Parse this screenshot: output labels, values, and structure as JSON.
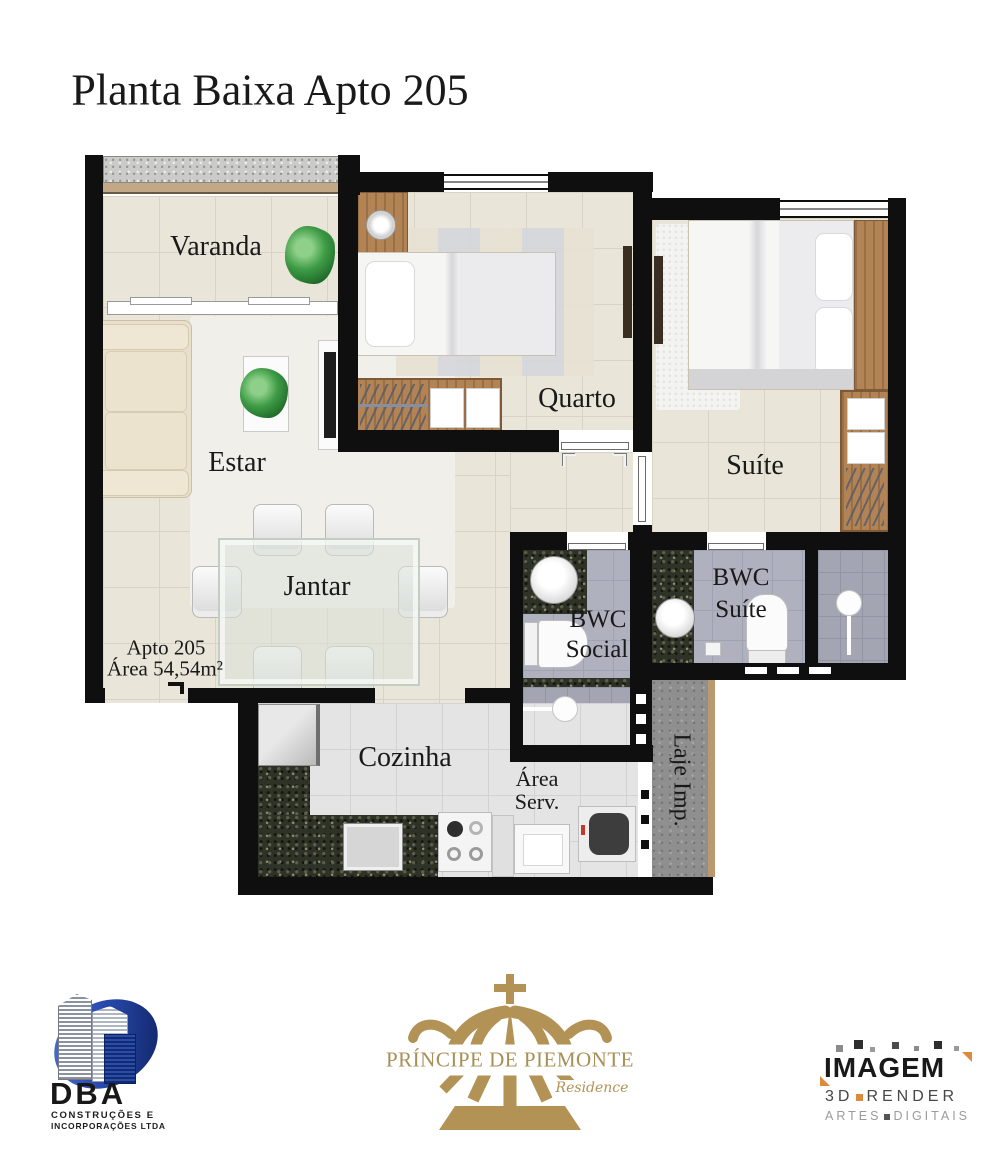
{
  "title": "Planta Baixa Apto 205",
  "plan": {
    "labels": {
      "varanda": "Varanda",
      "estar": "Estar",
      "jantar": "Jantar",
      "quarto": "Quarto",
      "suite": "Suíte",
      "bwc_social": [
        "BWC",
        "Social"
      ],
      "bwc_suite": [
        "BWC",
        "Suíte"
      ],
      "cozinha": "Cozinha",
      "area_serv": [
        "Área",
        "Serv."
      ],
      "laje": "Laje Imp.",
      "apto": "Apto 205",
      "area": "Área 54,54m²"
    }
  },
  "footer": {
    "dba": {
      "name": "DBA",
      "line1": "CONSTRUÇÕES E",
      "line2": "INCORPORAÇÕES LTDA"
    },
    "piemonte": {
      "name": "PRÍNCIPE DE PIEMONTE",
      "subtitle": "Residence"
    },
    "imagem": {
      "name": "IMAGEM",
      "line1_a": "3D",
      "line1_b": "RENDER",
      "line2_a": "ARTES",
      "line2_b": "DIGITAIS"
    }
  },
  "colors": {
    "wall": "#0f0f0f",
    "floor_beige": "#eae5d9",
    "floor_bath": "#afb2be",
    "floor_kitchen": "#e4e4e5",
    "granite": "#2f3227",
    "wood": "#b28455",
    "logo_gold": "#b29255",
    "dba_blue": "#1c3a8c",
    "imagem_orange": "#de8a3c"
  }
}
